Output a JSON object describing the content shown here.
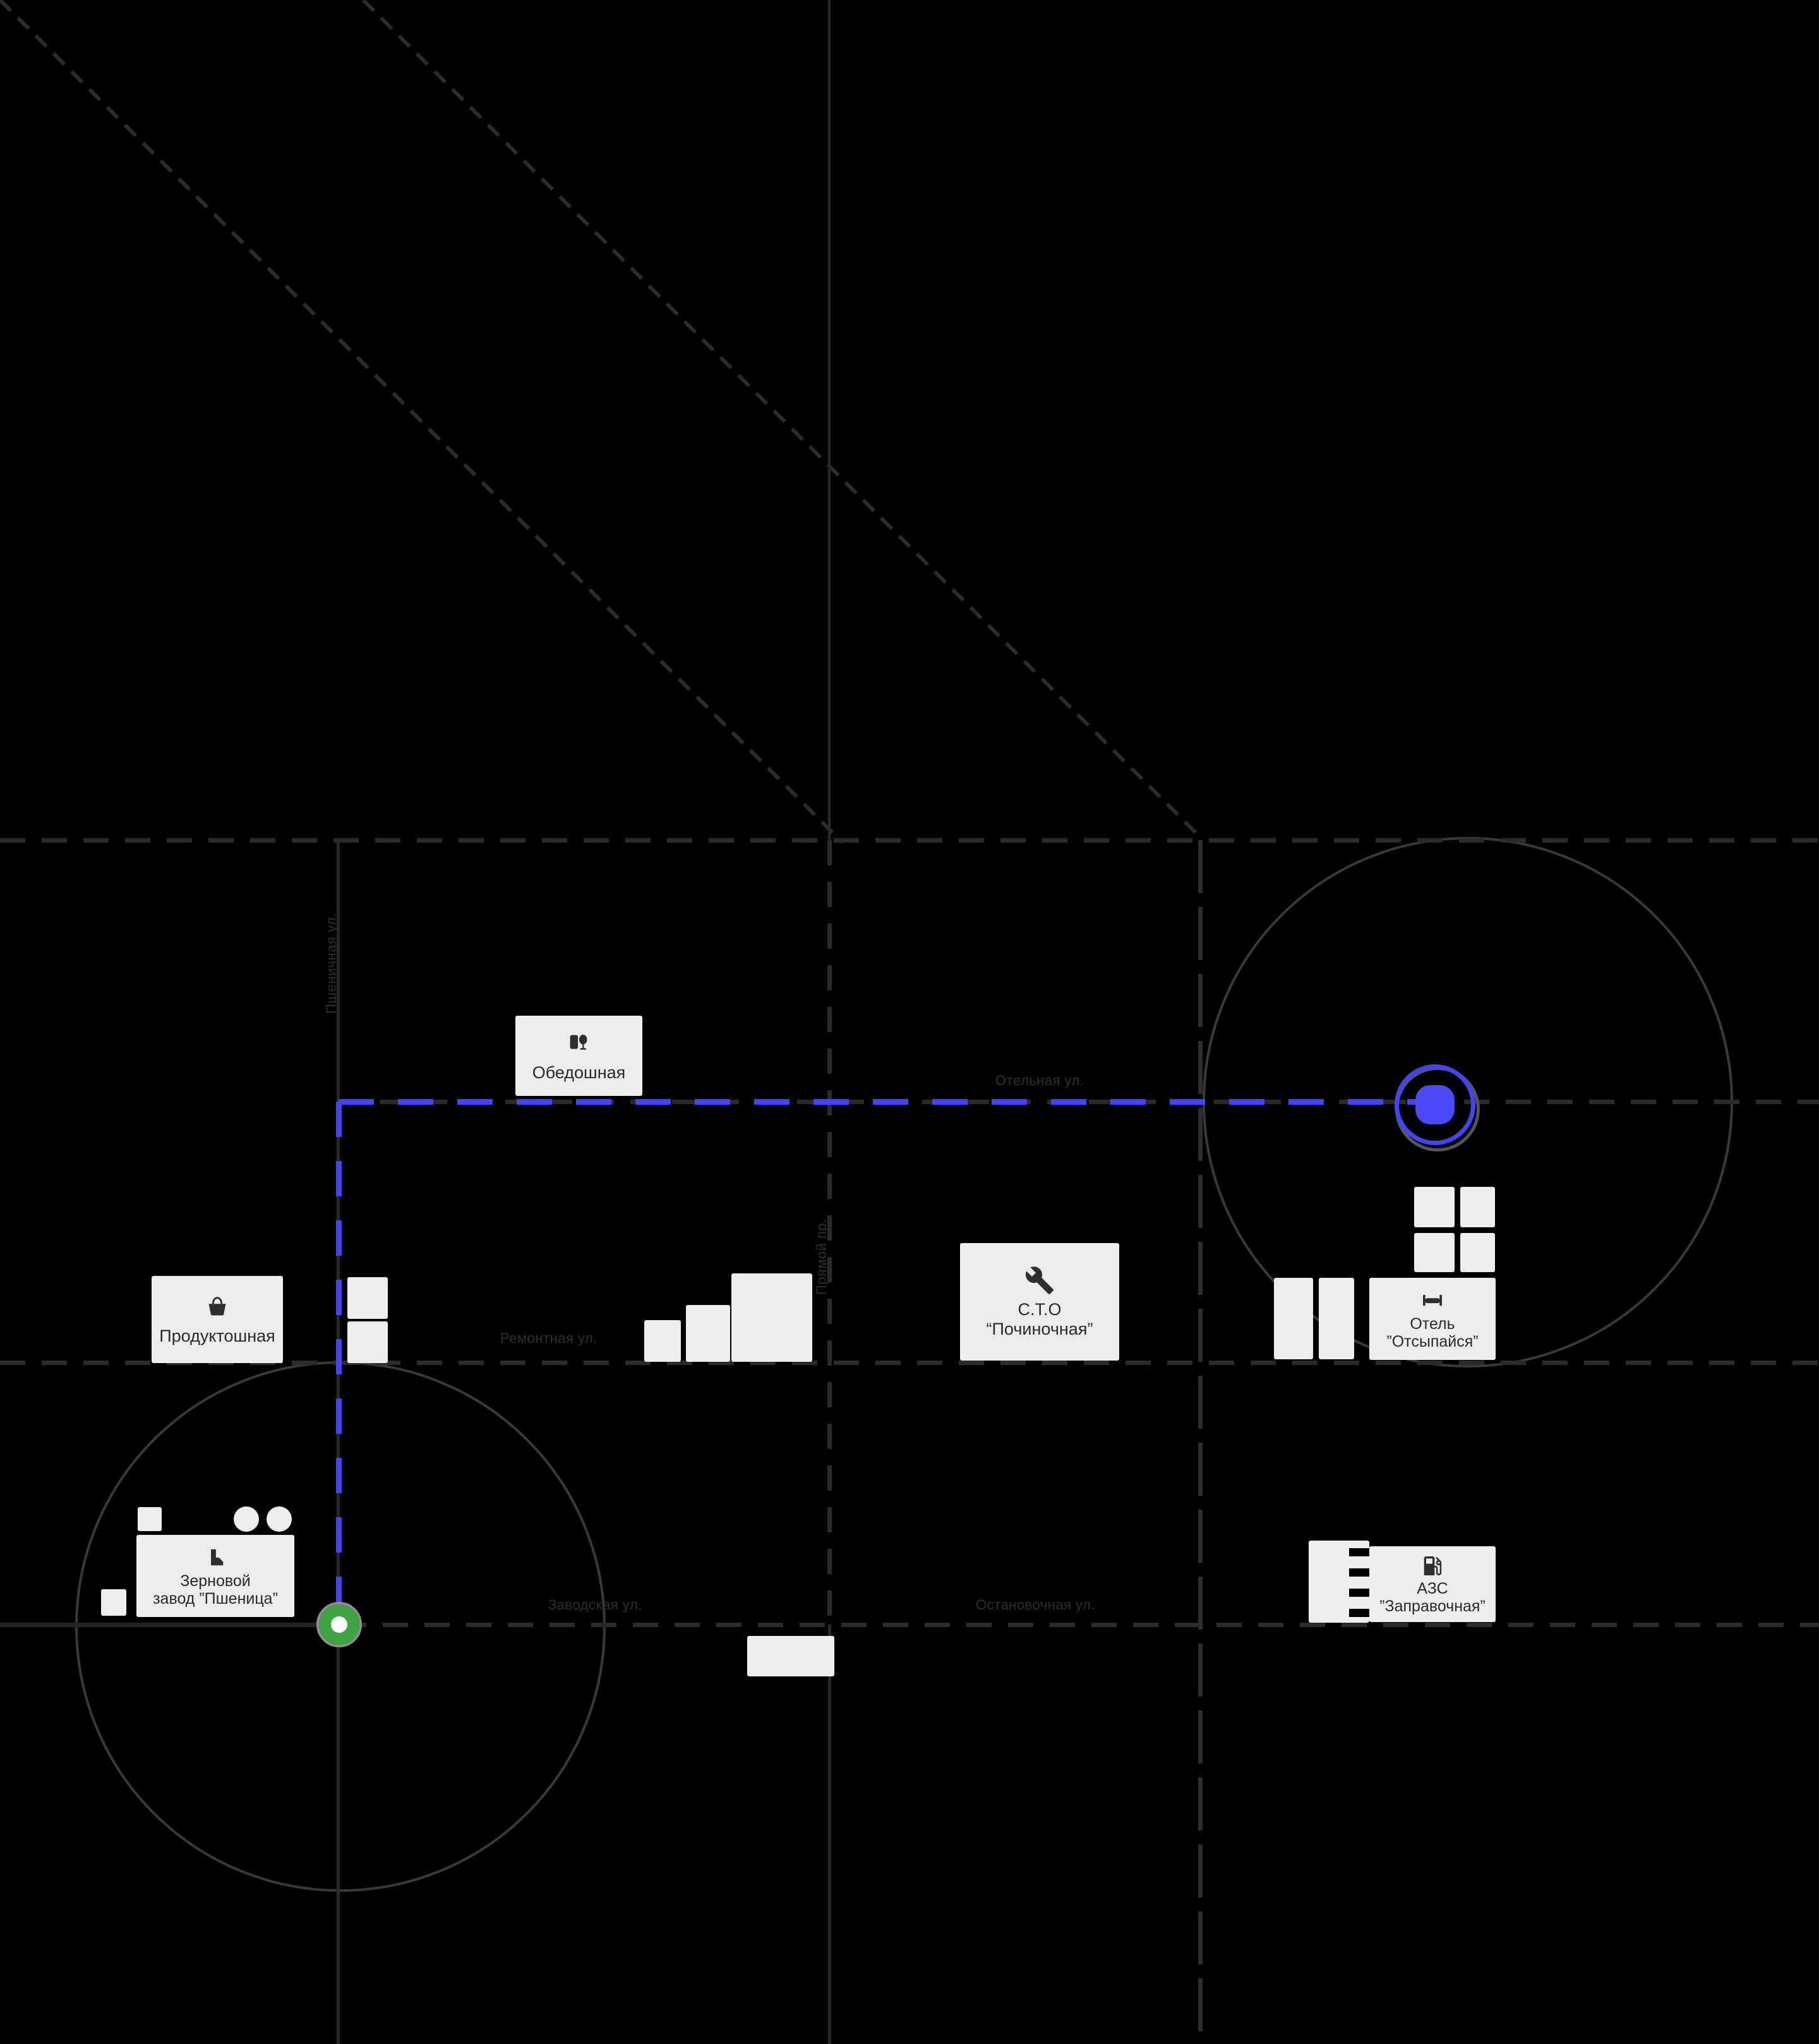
{
  "map": {
    "background_color": "#000000",
    "road_color": "#2a2a2c",
    "route_color": "#4644ef",
    "building_color": "#ededee",
    "zone_circle_color": "#39393b",
    "pois": {
      "obedoshnaya": {
        "label": "Обедошная",
        "icon": "restaurant-icon"
      },
      "produktoshnaya": {
        "label": "Продуктошная",
        "icon": "basket-icon"
      },
      "sto": {
        "line1": "С.Т.О",
        "line2": "“Починочная”",
        "icon": "wrench-icon"
      },
      "hotel": {
        "line1": "Отель",
        "line2": "”Отсыпайся”",
        "icon": "bed-icon"
      },
      "azs": {
        "line1": "АЗС",
        "line2": "”Заправочная”",
        "icon": "fuel-pump-icon"
      },
      "factory": {
        "line1": "Зерновой",
        "line2": "завод ”Пшеница”",
        "icon": "factory-icon"
      }
    },
    "streets": {
      "hotel_street": {
        "label": "Отельная ул."
      },
      "repair_street": {
        "label": "Ремонтная ул."
      },
      "factory_street": {
        "label": "Заводская ул."
      },
      "stop_street": {
        "label": "Остановочная ул."
      },
      "central_street": {
        "label": "Прямой пр."
      },
      "wheat_street": {
        "label": "Пшеничная ул."
      }
    },
    "markers": {
      "start": {
        "name": "route-start-marker",
        "color": "#3ea342"
      },
      "destination": {
        "name": "route-destination-marker",
        "color": "#4644ef"
      }
    }
  }
}
